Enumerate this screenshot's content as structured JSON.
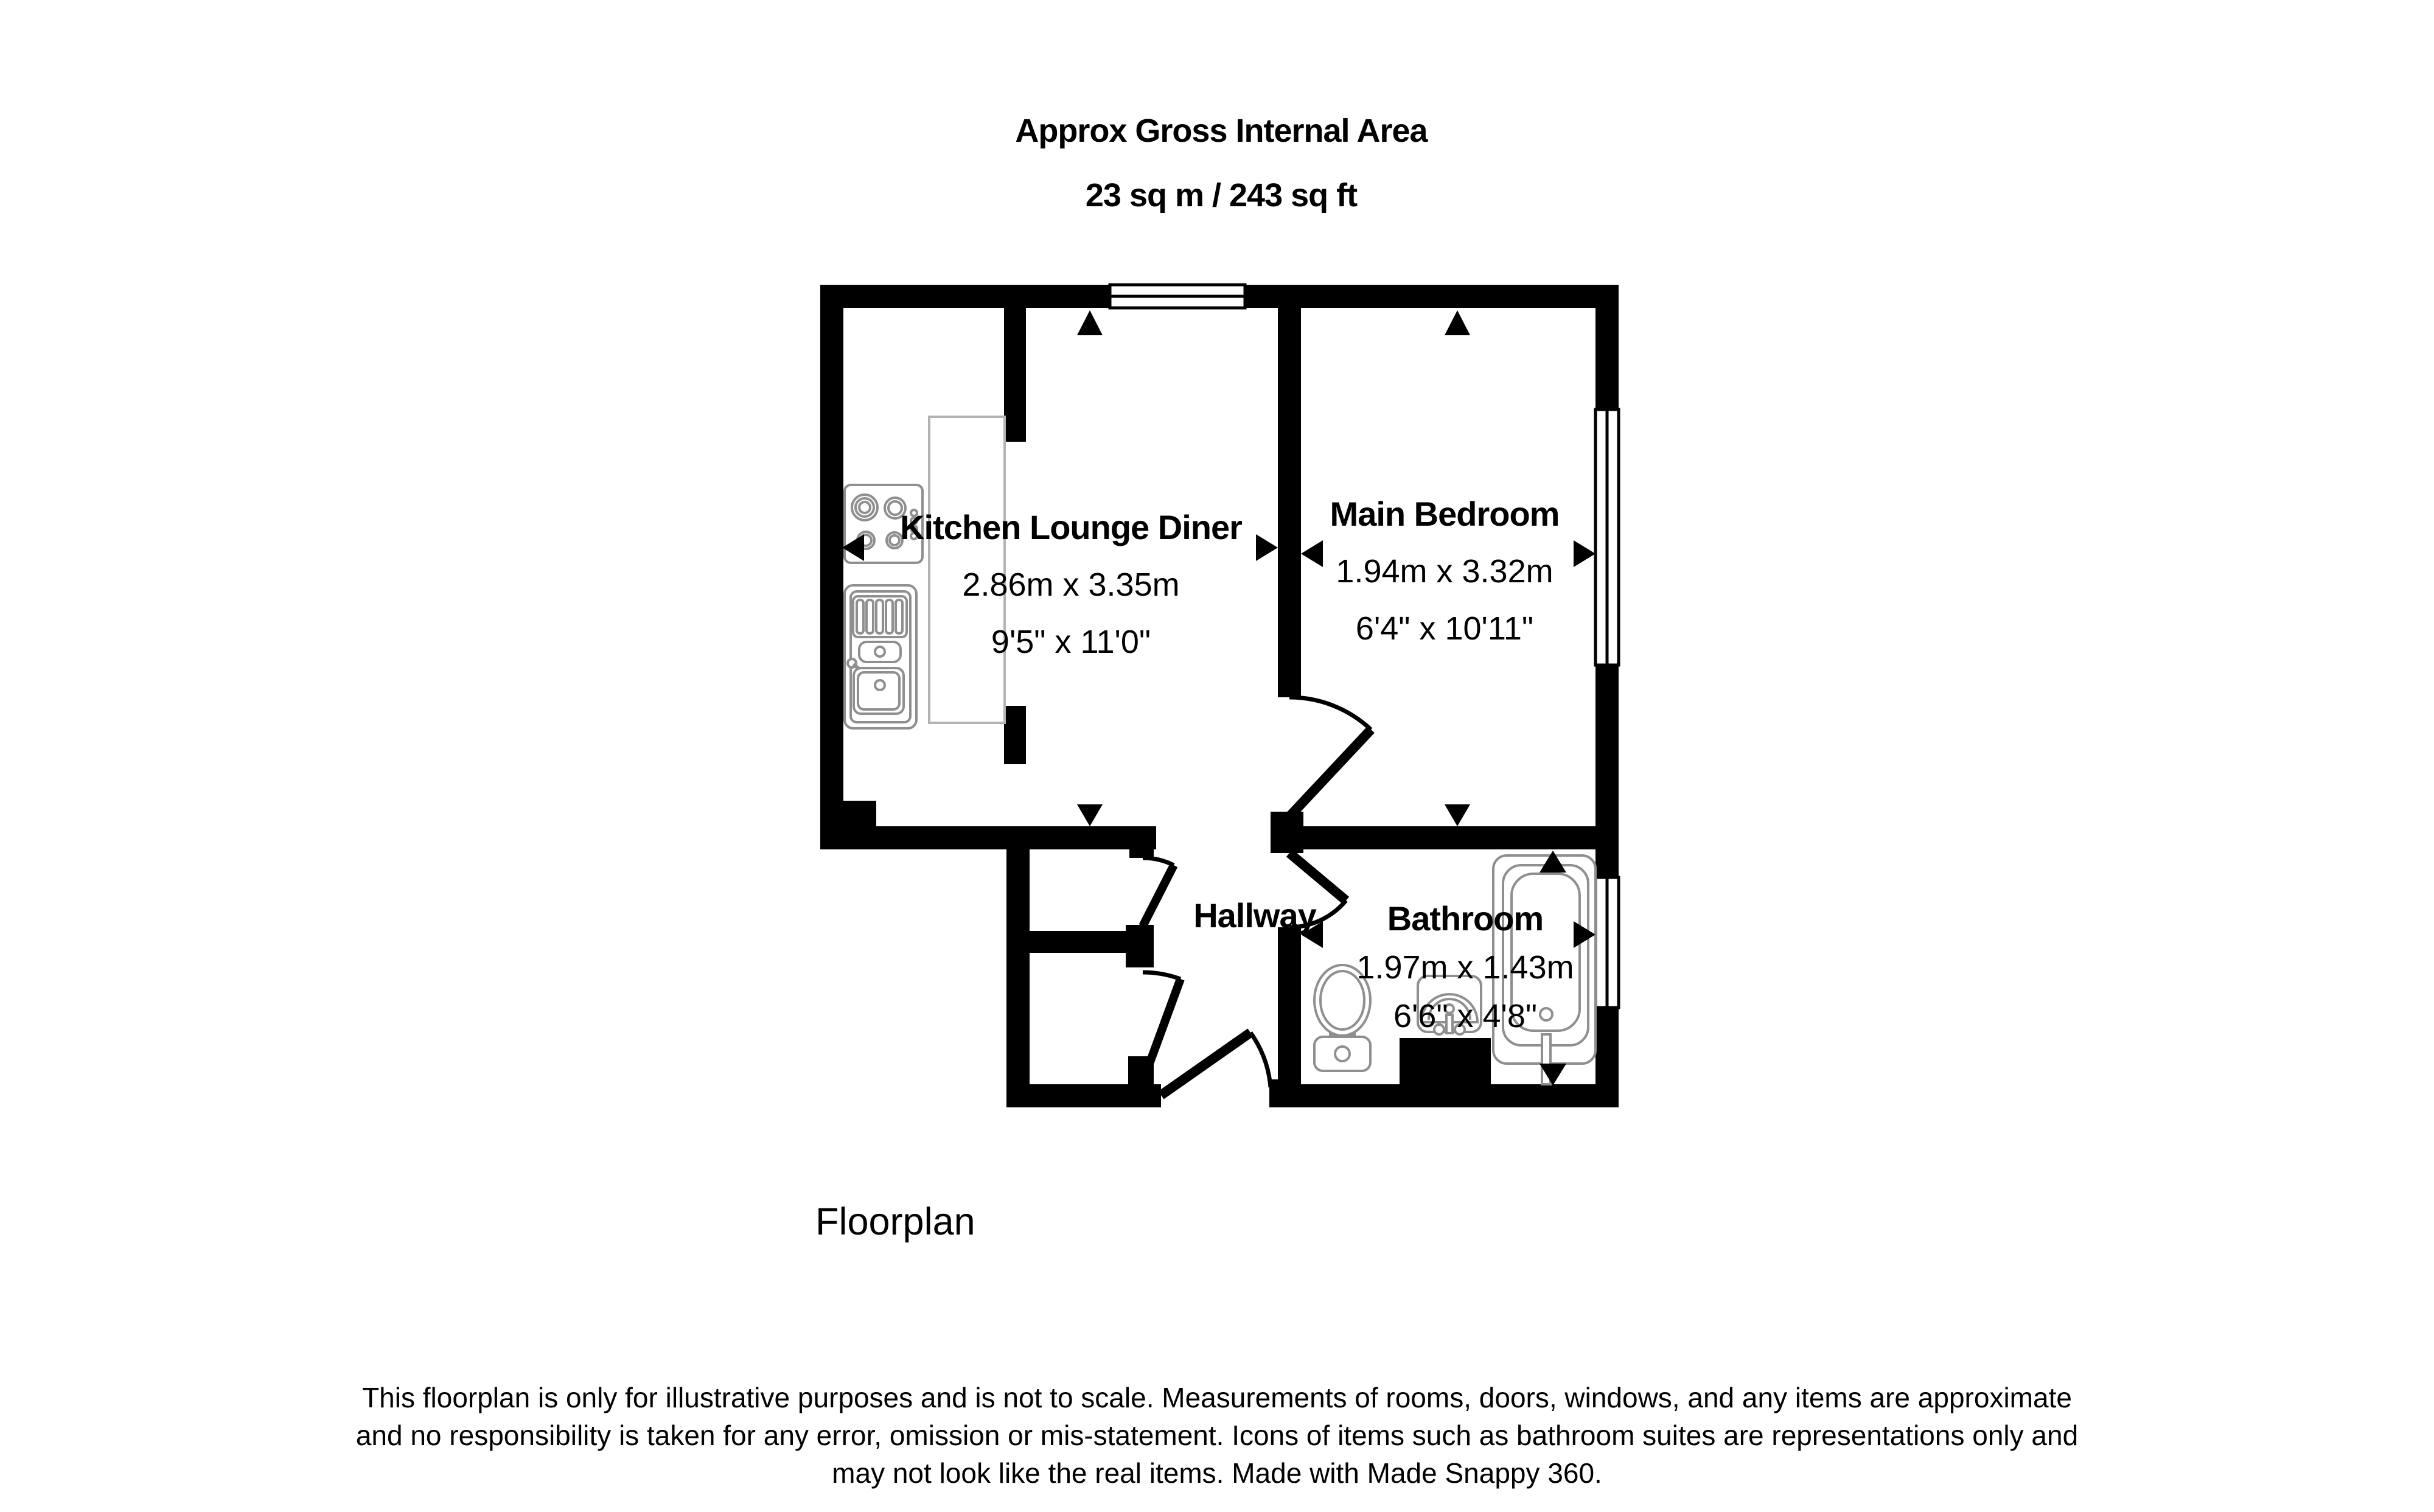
{
  "title": {
    "line1": "Approx Gross Internal Area",
    "line2": "23 sq m / 243 sq ft"
  },
  "rooms": {
    "kitchen": {
      "name": "Kitchen Lounge Diner",
      "metric": "2.86m x 3.35m",
      "imperial": "9'5\" x 11'0\""
    },
    "bedroom": {
      "name": "Main Bedroom",
      "metric": "1.94m x 3.32m",
      "imperial": "6'4\" x 10'11\""
    },
    "hallway": {
      "name": "Hallway"
    },
    "bathroom": {
      "name": "Bathroom",
      "metric": "1.97m x 1.43m",
      "imperial": "6'6\" x 4'8\""
    }
  },
  "caption": "Floorplan",
  "disclaimer": {
    "line1": "This floorplan is only for illustrative purposes and is not to scale. Measurements of rooms, doors, windows, and any items are approximate",
    "line2": "and no responsibility is taken for any error, omission or mis-statement. Icons of items such as bathroom suites are representations only and",
    "line3": "may not look like the real items. Made with Made Snappy 360."
  },
  "colors": {
    "wall": "#000000",
    "fixture": "#8f8f8f",
    "counter": "#b3b3b3",
    "background": "#ffffff"
  },
  "icons": [
    "hob-icon",
    "kitchen-sink-icon",
    "toilet-icon",
    "basin-icon",
    "bathtub-icon",
    "window-icon",
    "door-swing-icon",
    "measure-arrow-icon"
  ]
}
